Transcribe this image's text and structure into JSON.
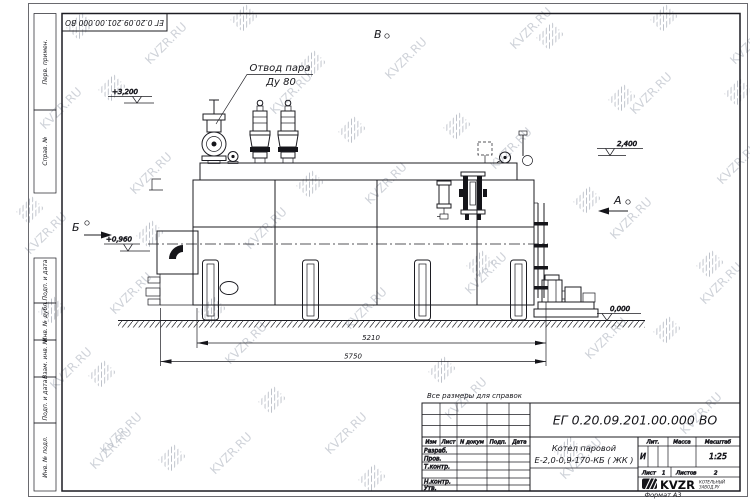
{
  "watermark": {
    "text": "KVZR.RU"
  },
  "corner_stamp": {
    "doc_number": "ЕГ 0.20.09.201.00.000  ВО"
  },
  "margin_columns": {
    "perv_primen": "Перв. примен.",
    "sprav_no": "Справ. №",
    "podp_data_1": "Подп. и дата",
    "inv_no_dubl": "Инв. № дубл.",
    "vzam_inv_no": "Взам. инв. №",
    "podp_data_2": "Подп. и дата",
    "inv_no_podl": "Инв. № подл."
  },
  "annotations": {
    "callout_line1": "Отвод пара",
    "callout_line2": "Ду 80",
    "view_top": "В",
    "view_right": "А",
    "view_left": "Б",
    "elev_top": "+3,200",
    "elev_right": "2,400",
    "elev_burner": "+0,960",
    "elev_ground": "0,000",
    "dim_inner": "5210",
    "dim_outer": "5750"
  },
  "note": "Все размеры для справок",
  "title_block": {
    "doc_number": "ЕГ 0.20.09.201.00.000  ВО",
    "cols": {
      "izm": "Изм",
      "list": "Лист",
      "n_dokum": "N докум",
      "podp": "Подп.",
      "data": "Дата"
    },
    "rows": {
      "razrab": "Разраб.",
      "prov": "Пров.",
      "t_kontr": "Т.контр.",
      "n_kontr": "Н.контр.",
      "utv": "Утв."
    },
    "product_line1": "Котел паровой",
    "product_line2": "Е-2,0-0,9-170-КБ ( ЖК )",
    "lit_label": "Лит.",
    "mass_label": "Масса",
    "scale_label": "Масштаб",
    "lit_value": "И",
    "scale_value": "1:25",
    "sheet_label": "Лист",
    "sheet_value": "1",
    "sheets_label": "Листов",
    "sheets_value": "2",
    "logo_text": "KVZR",
    "logo_sub1": "КОТЕЛЬНЫЙ",
    "logo_sub2": "ЗАВОД.РУ",
    "format_label": "Формат А3"
  },
  "colors": {
    "line": "#1c1c22",
    "watermark": "#b2b8c2",
    "paper": "#ffffff"
  }
}
